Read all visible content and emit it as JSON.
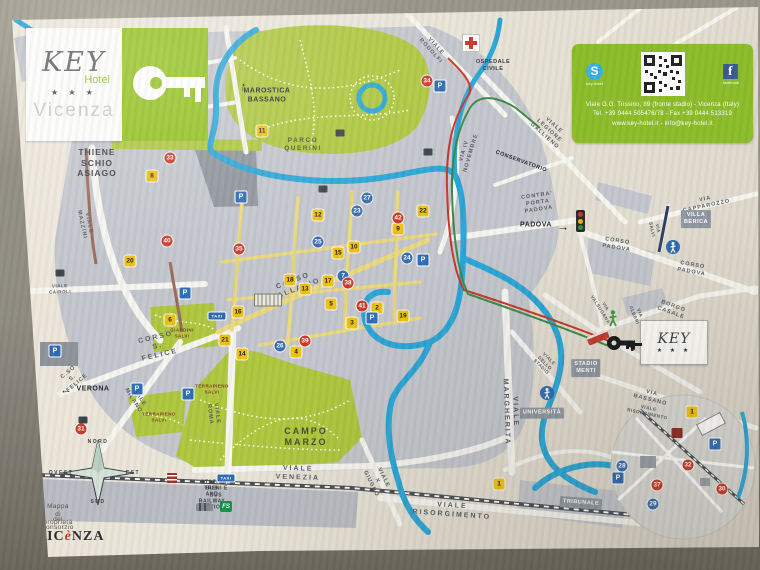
{
  "logo": {
    "brand": "KEY",
    "sub": "Hotel",
    "stars": "★ ★ ★",
    "city": "Vicenza"
  },
  "contact": {
    "skype_icon_letter": "S",
    "skype_label": "key-hotel",
    "facebook_icon_letter": "f",
    "facebook_label": "facebook",
    "line1": "Viale G.G. Trissino, 89 (fronte stadio) - Vicenza (Italy)",
    "line2": "Tel. +39 0444 505476/78 - Fax +39 0444 513319",
    "line3": "www.key-hotel.it - info@key-hotel.it"
  },
  "hotel_flag": {
    "brand": "KEY",
    "sub": "Hotel",
    "stars": "★ ★ ★"
  },
  "station": {
    "fs": "FS"
  },
  "footer": {
    "brand_pre": "VIC",
    "brand_accent": "è",
    "brand_post": "NZA"
  },
  "colors": {
    "accent_green": "#8cbd2a",
    "park_green": "#aec73e",
    "river_blue": "#2ba6d6",
    "marker_yellow": "#eec214",
    "marker_blue": "#3a6db2",
    "marker_red": "#cd3a28",
    "route_red": "#c8372b",
    "route_green": "#3d8a46"
  },
  "traffic_light_colors": [
    "#d23327",
    "#e8b900",
    "#2a9a2d"
  ],
  "map": {
    "labels": [
      {
        "t": "THIENE\nSCHIO\nASIAGO",
        "x": 97,
        "y": 163,
        "c": "dir big"
      },
      {
        "t": "↑",
        "x": 243,
        "y": 87,
        "r": 12,
        "c": "arrow"
      },
      {
        "t": "MAROSTICA\nBASSANO",
        "x": 267,
        "y": 96,
        "c": "dir"
      },
      {
        "t": "PARCO\nQUERINI",
        "x": 303,
        "y": 145,
        "c": "park"
      },
      {
        "t": "VIALE RODOLFI",
        "x": 433,
        "y": 49,
        "r": 48,
        "c": "street"
      },
      {
        "t": "OSPEDALE\nCIVILE",
        "x": 493,
        "y": 66,
        "c": "dir small"
      },
      {
        "t": "VIA IV NOVEMBRE",
        "x": 468,
        "y": 152,
        "r": -73,
        "c": "street"
      },
      {
        "t": "VIALE LEGIONE GALLIENO",
        "x": 549,
        "y": 131,
        "r": 42,
        "c": "street"
      },
      {
        "t": "CONSERVATORIO",
        "x": 521,
        "y": 162,
        "r": 20,
        "c": "street dark"
      },
      {
        "t": "CONTRA' PORTA PADOVA",
        "x": 538,
        "y": 203,
        "r": -8,
        "c": "street"
      },
      {
        "t": "PADOVA",
        "x": 536,
        "y": 226,
        "c": "dir"
      },
      {
        "t": "→",
        "x": 563,
        "y": 227,
        "c": "arrow"
      },
      {
        "t": "VIA CAPPAROZZO",
        "x": 706,
        "y": 203,
        "r": -12,
        "c": "street"
      },
      {
        "t": "CORSO PADOVA",
        "x": 617,
        "y": 245,
        "r": 9,
        "c": "street"
      },
      {
        "t": "CORSO PADOVA",
        "x": 692,
        "y": 269,
        "r": 10,
        "c": "street"
      },
      {
        "t": "VIA SALVI",
        "x": 655,
        "y": 229,
        "r": 78,
        "c": "street tiny"
      },
      {
        "t": "VILLA\nBERICA",
        "x": 696,
        "y": 219,
        "c": "box"
      },
      {
        "t": "VIA VALSUGANA",
        "x": 603,
        "y": 308,
        "r": 58,
        "c": "street tiny"
      },
      {
        "t": "VIA ALBERI",
        "x": 637,
        "y": 314,
        "r": 68,
        "c": "street tiny"
      },
      {
        "t": "BORGO CASALE",
        "x": 672,
        "y": 310,
        "r": 20,
        "c": "street"
      },
      {
        "t": "STADIO\nMENTI",
        "x": 586,
        "y": 368,
        "c": "box"
      },
      {
        "t": "VIALE DELLO STADIO",
        "x": 545,
        "y": 363,
        "r": 45,
        "c": "street tiny"
      },
      {
        "t": "UNIVERSITÀ",
        "x": 542,
        "y": 413,
        "c": "box"
      },
      {
        "t": "VIALE MARGHERITA",
        "x": 510,
        "y": 412,
        "r": 88,
        "c": "street big"
      },
      {
        "t": "VIA BASSANO",
        "x": 651,
        "y": 397,
        "r": 14,
        "c": "street"
      },
      {
        "t": "VIALE RISORGIMENTO",
        "x": 648,
        "y": 411,
        "r": 12,
        "c": "street tiny"
      },
      {
        "t": "TRIBUNALE",
        "x": 581,
        "y": 503,
        "r": 4,
        "c": "box"
      },
      {
        "t": "VIALE RISORGIMENTO",
        "x": 452,
        "y": 511,
        "r": 4,
        "c": "street big"
      },
      {
        "t": "VIALE X GIUGNO",
        "x": 377,
        "y": 481,
        "r": 64,
        "c": "street"
      },
      {
        "t": "VIALE VENEZIA",
        "x": 298,
        "y": 474,
        "r": 2,
        "c": "street big"
      },
      {
        "t": "STAZIONE TRENI E BUS",
        "x": 216,
        "y": 489,
        "c": "station"
      },
      {
        "t": "BUS AND RAILWAY STATION",
        "x": 212,
        "y": 498,
        "c": "station"
      },
      {
        "t": "CAMPO\nMARZO",
        "x": 306,
        "y": 437,
        "c": "park big"
      },
      {
        "t": "VIALE ROMA",
        "x": 213,
        "y": 414,
        "r": 83,
        "c": "street"
      },
      {
        "t": "GIARDINI\nSALVI",
        "x": 182,
        "y": 333,
        "c": "parkred"
      },
      {
        "t": "TERRAPIENO\nSALVI",
        "x": 212,
        "y": 389,
        "c": "parkred tiny"
      },
      {
        "t": "TERRAPIENO\nSALVI",
        "x": 159,
        "y": 417,
        "c": "parkred tiny"
      },
      {
        "t": "CORSO PALLADIO",
        "x": 295,
        "y": 286,
        "r": -21,
        "c": "street big"
      },
      {
        "t": "CORSO S. FELICE",
        "x": 158,
        "y": 347,
        "r": -13,
        "c": "street big"
      },
      {
        "t": "C.SO S. FELICE",
        "x": 73,
        "y": 378,
        "r": -40,
        "c": "street"
      },
      {
        "t": "←",
        "x": 66,
        "y": 390,
        "c": "arrow"
      },
      {
        "t": "VERONA",
        "x": 93,
        "y": 390,
        "c": "dir"
      },
      {
        "t": "VIALE MILANO",
        "x": 136,
        "y": 399,
        "r": 58,
        "c": "street"
      },
      {
        "t": "VIALE CAIROLI",
        "x": 60,
        "y": 289,
        "r": -2,
        "c": "street tiny"
      },
      {
        "t": "VIALE MAZZINI",
        "x": 85,
        "y": 224,
        "r": 78,
        "c": "street"
      },
      {
        "t": "NORD",
        "x": 98,
        "y": 442,
        "c": "compass"
      },
      {
        "t": "SUD",
        "x": 98,
        "y": 502,
        "c": "compass"
      },
      {
        "t": "EST",
        "x": 133,
        "y": 473,
        "c": "compass"
      },
      {
        "t": "OVEST",
        "x": 61,
        "y": 473,
        "c": "compass"
      },
      {
        "t": "Mappa di proprietà",
        "x": 58,
        "y": 515,
        "c": "note"
      },
      {
        "t": "del consorzio",
        "x": 58,
        "y": 524,
        "c": "note"
      }
    ],
    "markers": [
      {
        "n": "1",
        "k": "y",
        "x": 499,
        "y": 484
      },
      {
        "n": "2",
        "k": "y",
        "x": 377,
        "y": 308
      },
      {
        "n": "3",
        "k": "y",
        "x": 352,
        "y": 323
      },
      {
        "n": "4",
        "k": "y",
        "x": 296,
        "y": 352
      },
      {
        "n": "5",
        "k": "y",
        "x": 331,
        "y": 304
      },
      {
        "n": "6",
        "k": "y",
        "x": 170,
        "y": 320
      },
      {
        "n": "8",
        "k": "y",
        "x": 152,
        "y": 176
      },
      {
        "n": "9",
        "k": "y",
        "x": 398,
        "y": 229
      },
      {
        "n": "10",
        "k": "y",
        "x": 354,
        "y": 247
      },
      {
        "n": "11",
        "k": "y",
        "x": 262,
        "y": 131
      },
      {
        "n": "12",
        "k": "y",
        "x": 318,
        "y": 215
      },
      {
        "n": "13",
        "k": "y",
        "x": 305,
        "y": 289
      },
      {
        "n": "14",
        "k": "y",
        "x": 242,
        "y": 354
      },
      {
        "n": "15",
        "k": "y",
        "x": 338,
        "y": 253
      },
      {
        "n": "16",
        "k": "y",
        "x": 238,
        "y": 312
      },
      {
        "n": "17",
        "k": "y",
        "x": 328,
        "y": 281
      },
      {
        "n": "18",
        "k": "y",
        "x": 290,
        "y": 280
      },
      {
        "n": "19",
        "k": "y",
        "x": 403,
        "y": 316
      },
      {
        "n": "20",
        "k": "y",
        "x": 130,
        "y": 261
      },
      {
        "n": "21",
        "k": "y",
        "x": 225,
        "y": 340
      },
      {
        "n": "22",
        "k": "y",
        "x": 423,
        "y": 211
      },
      {
        "n": "1",
        "k": "y",
        "x": 692,
        "y": 412
      },
      {
        "n": "7",
        "k": "b",
        "x": 343,
        "y": 276
      },
      {
        "n": "23",
        "k": "b",
        "x": 357,
        "y": 211
      },
      {
        "n": "24",
        "k": "b",
        "x": 407,
        "y": 258
      },
      {
        "n": "25",
        "k": "b",
        "x": 318,
        "y": 242
      },
      {
        "n": "26",
        "k": "b",
        "x": 280,
        "y": 346
      },
      {
        "n": "27",
        "k": "b",
        "x": 367,
        "y": 198
      },
      {
        "n": "28",
        "k": "b",
        "x": 622,
        "y": 466
      },
      {
        "n": "29",
        "k": "b",
        "x": 653,
        "y": 504
      },
      {
        "n": "30",
        "k": "r",
        "x": 722,
        "y": 489
      },
      {
        "n": "31",
        "k": "r",
        "x": 81,
        "y": 429
      },
      {
        "n": "32",
        "k": "r",
        "x": 688,
        "y": 465
      },
      {
        "n": "33",
        "k": "r",
        "x": 170,
        "y": 158
      },
      {
        "n": "34",
        "k": "r",
        "x": 427,
        "y": 81
      },
      {
        "n": "35",
        "k": "r",
        "x": 239,
        "y": 249
      },
      {
        "n": "37",
        "k": "r",
        "x": 657,
        "y": 485
      },
      {
        "n": "38",
        "k": "r",
        "x": 348,
        "y": 283
      },
      {
        "n": "39",
        "k": "r",
        "x": 305,
        "y": 341
      },
      {
        "n": "40",
        "k": "r",
        "x": 167,
        "y": 241
      },
      {
        "n": "41",
        "k": "r",
        "x": 362,
        "y": 306
      },
      {
        "n": "42",
        "k": "r",
        "x": 398,
        "y": 218
      }
    ],
    "pins": [
      {
        "k": "p",
        "t": "P",
        "x": 440,
        "y": 86
      },
      {
        "k": "p",
        "t": "P",
        "x": 241,
        "y": 197
      },
      {
        "k": "p",
        "t": "P",
        "x": 185,
        "y": 293
      },
      {
        "k": "p",
        "t": "P",
        "x": 55,
        "y": 351
      },
      {
        "k": "p",
        "t": "P",
        "x": 137,
        "y": 389
      },
      {
        "k": "p",
        "t": "P",
        "x": 188,
        "y": 394
      },
      {
        "k": "p",
        "t": "P",
        "x": 423,
        "y": 260
      },
      {
        "k": "p",
        "t": "P",
        "x": 372,
        "y": 318
      },
      {
        "k": "p",
        "t": "P",
        "x": 715,
        "y": 444
      },
      {
        "k": "p",
        "t": "P",
        "x": 618,
        "y": 478
      },
      {
        "k": "taxi",
        "t": "TAXI",
        "x": 217,
        "y": 316
      },
      {
        "k": "taxi",
        "t": "TAXI",
        "x": 226,
        "y": 478
      },
      {
        "k": "bld",
        "x": 60,
        "y": 273
      },
      {
        "k": "bld",
        "x": 83,
        "y": 420
      },
      {
        "k": "bld",
        "x": 340,
        "y": 133
      },
      {
        "k": "bld",
        "x": 428,
        "y": 152
      },
      {
        "k": "bld",
        "x": 323,
        "y": 189
      },
      {
        "k": "bldr",
        "x": 677,
        "y": 433
      },
      {
        "k": "bas",
        "x": 268,
        "y": 300
      }
    ]
  }
}
